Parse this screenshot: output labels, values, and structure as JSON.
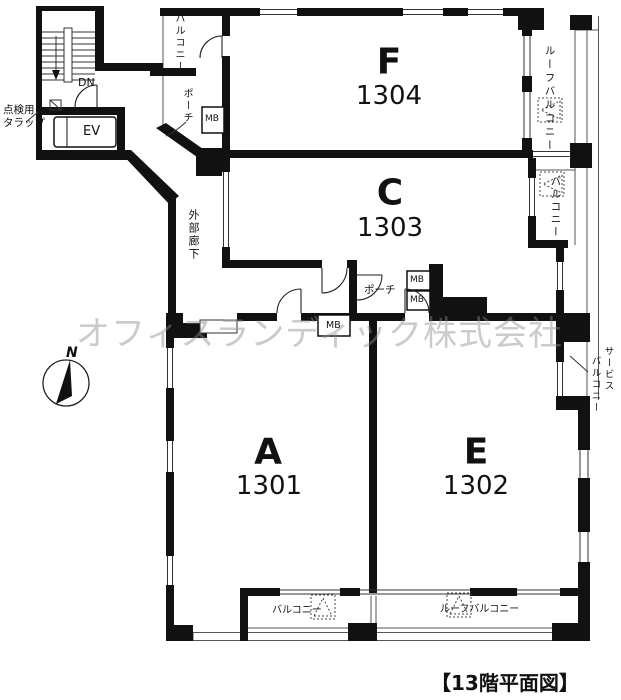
{
  "floor_title": "【13階平面図】",
  "watermark": "オフィスランディック株式会社",
  "compass": {
    "north": "N"
  },
  "stairwell": {
    "down": "DN",
    "elevator": "EV",
    "inspection_ladder_line1": "点検用",
    "inspection_ladder_line2": "タラップ"
  },
  "corridor": {
    "label": "外部廊下"
  },
  "units": {
    "f": {
      "name": "F",
      "number": "1304"
    },
    "c": {
      "name": "C",
      "number": "1303"
    },
    "a": {
      "name": "A",
      "number": "1301"
    },
    "e": {
      "name": "E",
      "number": "1302"
    }
  },
  "labels": {
    "balcony": "バルコニー",
    "roof_balcony": "ルーフバルコニー",
    "porch": "ポーチ",
    "meter_box": "MB",
    "service_balcony_line1": "サービス",
    "service_balcony_line2": "バルコニー"
  },
  "colors": {
    "wall": "#111111",
    "thin_line": "#444444",
    "text": "#111111",
    "watermark": "#c9c9c9"
  }
}
